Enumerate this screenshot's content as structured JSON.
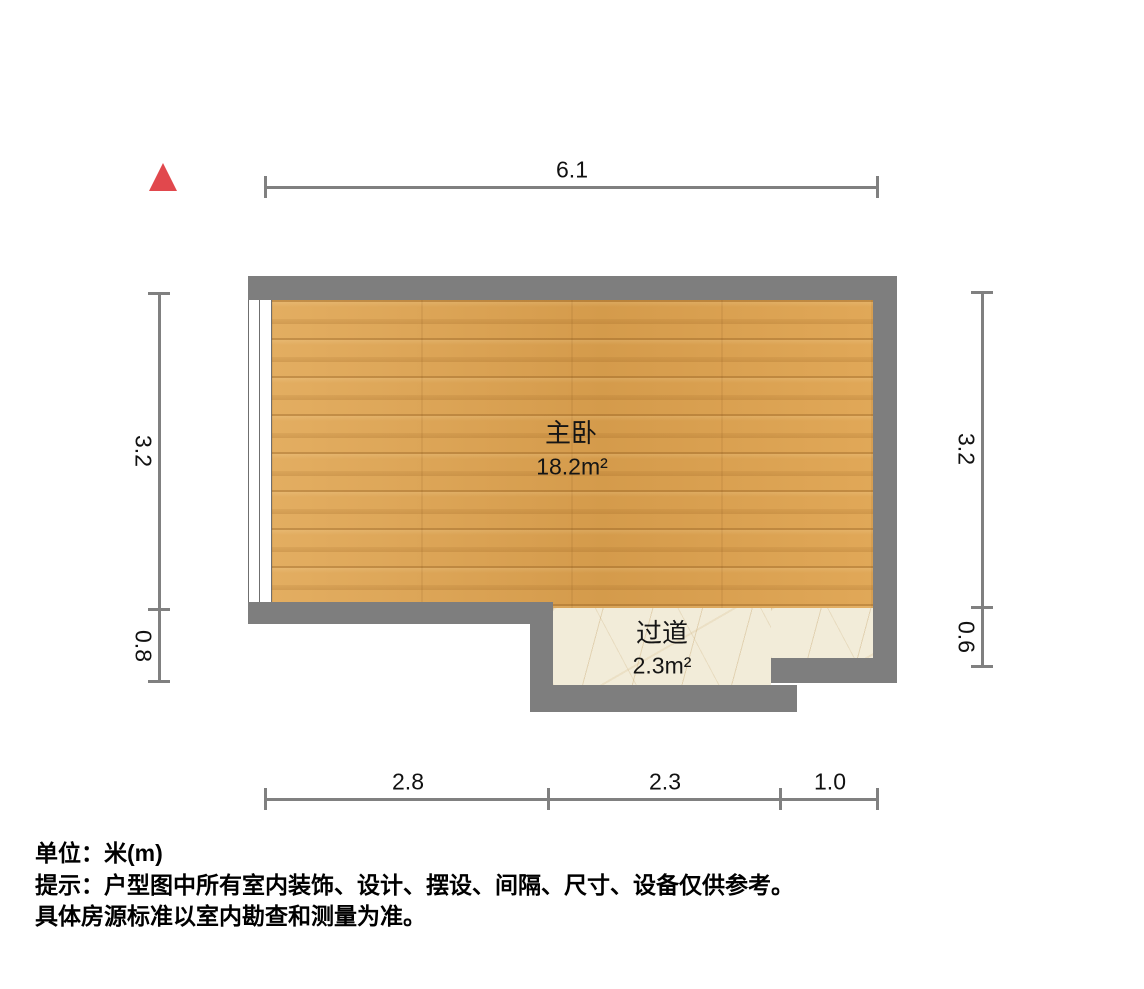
{
  "floor_plan": {
    "rooms": {
      "bedroom": {
        "name": "主卧",
        "area": "18.2m²",
        "floor": "wood"
      },
      "hallway": {
        "name": "过道",
        "area": "2.3m²",
        "floor": "marble-tile"
      }
    },
    "dimensions": {
      "top": [
        "6.1"
      ],
      "left": [
        "3.2",
        "0.8"
      ],
      "right": [
        "3.2",
        "0.6"
      ],
      "bottom": [
        "2.8",
        "2.3",
        "1.0"
      ]
    },
    "footer": {
      "unit_line": "单位：米(m)",
      "hint_line1": "提示：户型图中所有室内装饰、设计、摆设、间隔、尺寸、设备仅供参考。",
      "hint_line2": "具体房源标准以室内勘查和测量为准。"
    },
    "icons": {
      "north_indicator": "north-triangle"
    },
    "colors": {
      "wall": "#7e7e7e",
      "wood_floor": "#dda14e",
      "tile_floor": "#f2ecd9",
      "north_arrow": "#e1484d",
      "dim_line": "#808080",
      "text": "#111111"
    }
  }
}
